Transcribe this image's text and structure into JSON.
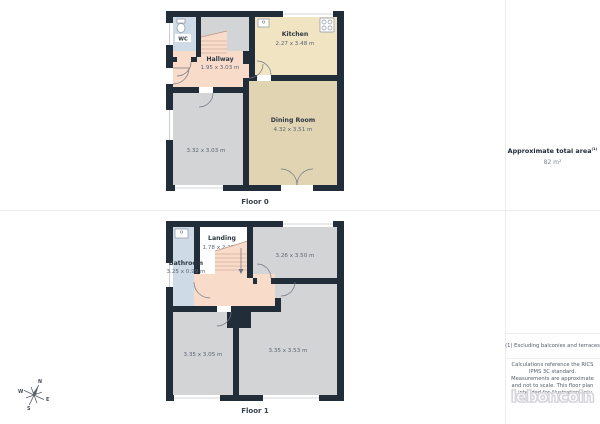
{
  "colors": {
    "wall": "#222d3a",
    "hallway_pink": "#f8dbc9",
    "kitchen_cream": "#f0e4c3",
    "dining_tan": "#e0d4b2",
    "wet_room_blue": "#cfdae7",
    "room_gray": "#d3d4d6",
    "background": "#ffffff"
  },
  "floor0": {
    "caption": "Floor 0",
    "rooms": {
      "wc": {
        "name": "WC"
      },
      "hallway": {
        "name": "Hallway",
        "dims": "1.95 x 3.03 m"
      },
      "kitchen": {
        "name": "Kitchen",
        "dims": "2.27 x 3.48 m"
      },
      "dining": {
        "name": "Dining Room",
        "dims": "4.32 x 3.51 m"
      },
      "room1": {
        "dims": "3.32 x 3.03 m"
      }
    }
  },
  "floor1": {
    "caption": "Floor 1",
    "rooms": {
      "landing": {
        "name": "Landing",
        "dims": "1.78 x 2.25 m"
      },
      "bathroom": {
        "name": "Bathroom",
        "dims": "3.25 x 0.99 m"
      },
      "room2": {
        "dims": "3.26 x 3.50 m"
      },
      "room3": {
        "dims": "3.35 x 3.05 m"
      },
      "room4": {
        "dims": "3.35 x 3.53 m"
      }
    }
  },
  "panel": {
    "area_title": "Approximate total area",
    "area_superscript": "(1)",
    "area_value": "82 m²",
    "footnote": "(1) Excluding balconies and terraces",
    "disclaimer": "Calculations reference the RICS IPMS 3C standard. Measurements are approximate and not to scale. This floor plan is intended for illustration only.",
    "brand": "leboncoin"
  },
  "compass": {
    "n": "N",
    "e": "E",
    "s": "S",
    "w": "W"
  }
}
